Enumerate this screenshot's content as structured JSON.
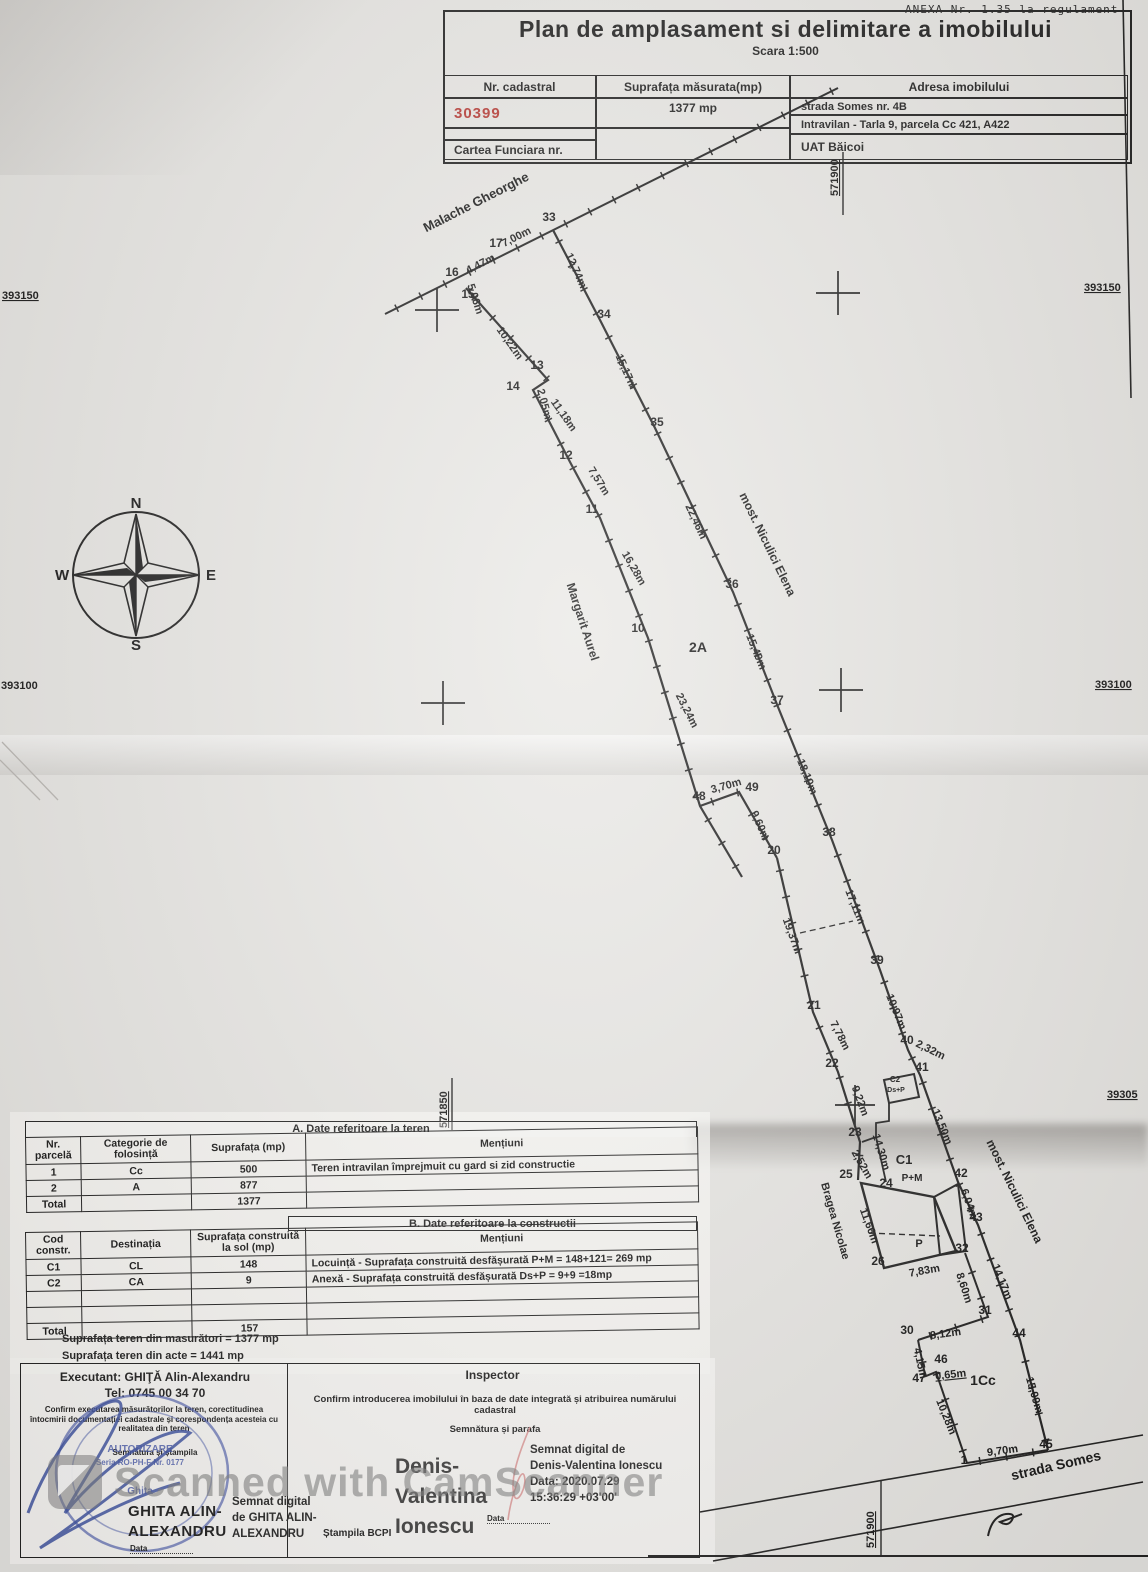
{
  "annex": "ANEXA Nr. 1.35 la regulament",
  "title": "Plan de amplasament si delimitare a imobilului",
  "scale_note": "Scara 1:500",
  "header_table": {
    "nr_cadastral_label": "Nr. cadastral",
    "nr_cadastral_value": "30399",
    "suprafata_label": "Suprafața măsurata(mp)",
    "suprafata_value": "1377 mp",
    "adresa_label": "Adresa imobilului",
    "adresa_line1": "strada Somes nr. 4B",
    "adresa_line2": "Intravilan - Tarla 9, parcela Cc 421, A422",
    "carte_funciara_label": "Cartea Funciara nr.",
    "uat_value": "UAT  Băicoi"
  },
  "compass": {
    "n": "N",
    "e": "E",
    "s": "S",
    "w": "W"
  },
  "table_a": {
    "title": "A. Date referitoare la teren",
    "headers": [
      "Nr. parcelă",
      "Categorie de folosință",
      "Suprafața (mp)",
      "Mențiuni"
    ],
    "rows": [
      [
        "1",
        "Cc",
        "500",
        "Teren intravilan împrejmuit cu gard si zid constructie"
      ],
      [
        "2",
        "A",
        "877",
        ""
      ],
      [
        "Total",
        "",
        "1377",
        ""
      ]
    ]
  },
  "table_b": {
    "title": "B. Date referitoare la constructii",
    "headers": [
      "Cod constr.",
      "Destinația",
      "Suprafața construită la sol (mp)",
      "Mențiuni"
    ],
    "rows": [
      [
        "C1",
        "CL",
        "148",
        "Locuință - Suprafața construită desfășurată P+M = 148+121= 269 mp"
      ],
      [
        "C2",
        "CA",
        "9",
        "Anexă - Suprafața construită desfășurată Ds+P = 9+9 =18mp"
      ],
      [
        "",
        "",
        "",
        ""
      ],
      [
        "",
        "",
        "",
        ""
      ],
      [
        "Total",
        "",
        "157",
        ""
      ]
    ]
  },
  "summary": {
    "line1": "Suprafața teren din masurători = 1377 mp",
    "line2": "Suprafața teren din acte = 1441 mp"
  },
  "signature": {
    "executant_label": "Executant: GHIŢĂ Alin-Alexandru",
    "executant_tel": "Tel: 0745 00 34 70",
    "executant_confirm": "Confirm executarea măsurătorilor la teren, corectitudinea întocmirii documentației cadastrale și corespondența acesteia cu realitatea din teren",
    "semnatura_stampila": "Semnătura și ștampila",
    "stamp_line1": "AUTORIZARE",
    "stamp_line2": "Seria RO-PH-F Nr. 0177",
    "stamp_line3": "Ghita",
    "executant_name_l1": "GHITA ALIN-",
    "executant_name_l2": "ALEXANDRU",
    "executant_digital": [
      "Semnat digital",
      "de GHITA ALIN-",
      "ALEXANDRU"
    ],
    "data_label": "Data",
    "inspector_label": "Inspector",
    "inspector_confirm": "Confirm introducerea imobilului în baza de date integrată și atribuirea numărului cadastral",
    "semnatura_parafa": "Semnătura și parafa",
    "inspector_name": [
      "Denis-",
      "Valentina",
      "Ionescu"
    ],
    "inspector_digital": [
      "Semnat digital de",
      "Denis-Valentina Ionescu",
      "Data: 2020.07.29",
      "15:36:29 +03'00'"
    ],
    "stampila_bcpi": "Ștampila BCPI"
  },
  "watermark": "Scanned with CamScanner",
  "colors": {
    "cadastral_red": "#b5342e",
    "stamp_blue": "#4053a8",
    "parafa_red": "#d98a8a"
  },
  "plan": {
    "points": [
      {
        "t": "15",
        "x": 468,
        "y": 298
      },
      {
        "t": "16",
        "x": 452,
        "y": 276
      },
      {
        "t": "17",
        "x": 496,
        "y": 247
      },
      {
        "t": "33",
        "x": 549,
        "y": 221
      },
      {
        "t": "13",
        "x": 537,
        "y": 369
      },
      {
        "t": "14",
        "x": 513,
        "y": 390
      },
      {
        "t": "12",
        "x": 566,
        "y": 459
      },
      {
        "t": "11",
        "x": 592,
        "y": 513
      },
      {
        "t": "34",
        "x": 604,
        "y": 318
      },
      {
        "t": "35",
        "x": 657,
        "y": 426
      },
      {
        "t": "10",
        "x": 638,
        "y": 632
      },
      {
        "t": "36",
        "x": 732,
        "y": 588
      },
      {
        "t": "37",
        "x": 777,
        "y": 704
      },
      {
        "t": "48",
        "x": 699,
        "y": 800
      },
      {
        "t": "49",
        "x": 752,
        "y": 791
      },
      {
        "t": "20",
        "x": 774,
        "y": 854
      },
      {
        "t": "38",
        "x": 829,
        "y": 836
      },
      {
        "t": "39",
        "x": 877,
        "y": 964
      },
      {
        "t": "21",
        "x": 814,
        "y": 1009
      },
      {
        "t": "22",
        "x": 832,
        "y": 1067
      },
      {
        "t": "40",
        "x": 907,
        "y": 1044
      },
      {
        "t": "41",
        "x": 922,
        "y": 1071
      },
      {
        "t": "23",
        "x": 855,
        "y": 1136
      },
      {
        "t": "25",
        "x": 846,
        "y": 1178
      },
      {
        "t": "24",
        "x": 886,
        "y": 1187
      },
      {
        "t": "42",
        "x": 961,
        "y": 1177
      },
      {
        "t": "43",
        "x": 976,
        "y": 1221
      },
      {
        "t": "26",
        "x": 878,
        "y": 1265
      },
      {
        "t": "32",
        "x": 962,
        "y": 1252
      },
      {
        "t": "31",
        "x": 985,
        "y": 1314
      },
      {
        "t": "30",
        "x": 907,
        "y": 1334
      },
      {
        "t": "47",
        "x": 919,
        "y": 1382
      },
      {
        "t": "46",
        "x": 941,
        "y": 1363
      },
      {
        "t": "44",
        "x": 1019,
        "y": 1337
      },
      {
        "t": "45",
        "x": 1046,
        "y": 1448
      },
      {
        "t": "1",
        "x": 964,
        "y": 1464
      }
    ],
    "distances": [
      {
        "t": "7,00m",
        "x": 518,
        "y": 240,
        "r": -27
      },
      {
        "t": "4,47m",
        "x": 482,
        "y": 267,
        "r": -27
      },
      {
        "t": "5,06m",
        "x": 472,
        "y": 300,
        "r": 72
      },
      {
        "t": "10,22m",
        "x": 507,
        "y": 345,
        "r": 55
      },
      {
        "t": "2,05m",
        "x": 541,
        "y": 405,
        "r": 75
      },
      {
        "t": "11,18m",
        "x": 561,
        "y": 417,
        "r": 55
      },
      {
        "t": "7,57m",
        "x": 596,
        "y": 483,
        "r": 58
      },
      {
        "t": "16,28m",
        "x": 631,
        "y": 570,
        "r": 60
      },
      {
        "t": "23,24m",
        "x": 684,
        "y": 712,
        "r": 63
      },
      {
        "t": "3,70m",
        "x": 727,
        "y": 789,
        "r": -16
      },
      {
        "t": "9,60m",
        "x": 757,
        "y": 827,
        "r": 66
      },
      {
        "t": "19,37m",
        "x": 789,
        "y": 937,
        "r": 70
      },
      {
        "t": "7,78m",
        "x": 837,
        "y": 1037,
        "r": 63
      },
      {
        "t": "9,22m",
        "x": 857,
        "y": 1102,
        "r": 70
      },
      {
        "t": "14,30m",
        "x": 878,
        "y": 1153,
        "r": 73
      },
      {
        "t": "2,52m",
        "x": 859,
        "y": 1166,
        "r": 60
      },
      {
        "t": "11,66m",
        "x": 866,
        "y": 1227,
        "r": 70
      },
      {
        "t": "7,83m",
        "x": 925,
        "y": 1274,
        "r": -10
      },
      {
        "t": "8,60m",
        "x": 961,
        "y": 1289,
        "r": 72
      },
      {
        "t": "8,12m",
        "x": 946,
        "y": 1337,
        "r": -8
      },
      {
        "t": "4,15m",
        "x": 917,
        "y": 1364,
        "r": 78
      },
      {
        "t": "0,65m",
        "x": 951,
        "y": 1378,
        "r": -6,
        "u": true
      },
      {
        "t": "10,28m",
        "x": 943,
        "y": 1418,
        "r": 68
      },
      {
        "t": "9,70m",
        "x": 1003,
        "y": 1454,
        "r": -8
      },
      {
        "t": "12,74m",
        "x": 573,
        "y": 272,
        "r": 66
      },
      {
        "t": "15,17m",
        "x": 623,
        "y": 373,
        "r": 66
      },
      {
        "t": "22,46m",
        "x": 693,
        "y": 523,
        "r": 65
      },
      {
        "t": "15,40m",
        "x": 753,
        "y": 653,
        "r": 68
      },
      {
        "t": "18,10m",
        "x": 804,
        "y": 778,
        "r": 68
      },
      {
        "t": "17,11m",
        "x": 852,
        "y": 908,
        "r": 68
      },
      {
        "t": "10,97m",
        "x": 893,
        "y": 1013,
        "r": 68
      },
      {
        "t": "2,32m",
        "x": 929,
        "y": 1053,
        "r": 26
      },
      {
        "t": "13,50m",
        "x": 939,
        "y": 1128,
        "r": 68
      },
      {
        "t": "6,04m",
        "x": 966,
        "y": 1205,
        "r": 70
      },
      {
        "t": "14,17m",
        "x": 999,
        "y": 1283,
        "r": 68
      },
      {
        "t": "15,09m",
        "x": 1031,
        "y": 1396,
        "r": 74
      }
    ],
    "names": [
      {
        "t": "Malache Gheorghe",
        "x": 478,
        "y": 206,
        "r": -27,
        "s": 13
      },
      {
        "t": "most. Niculici Elena",
        "x": 764,
        "y": 546,
        "r": 64,
        "s": 12
      },
      {
        "t": "Margarit Aurel",
        "x": 579,
        "y": 623,
        "r": 72,
        "s": 12
      },
      {
        "t": "most. Niculici Elena",
        "x": 1011,
        "y": 1193,
        "r": 64,
        "s": 12
      },
      {
        "t": "Bragea Nicolae",
        "x": 832,
        "y": 1222,
        "r": 74,
        "s": 11
      },
      {
        "t": "strada Somes",
        "x": 1057,
        "y": 1470,
        "r": -13,
        "s": 14
      }
    ],
    "parcel_labels": [
      {
        "t": "2A",
        "x": 698,
        "y": 652,
        "s": 14
      },
      {
        "t": "1Cc",
        "x": 983,
        "y": 1385,
        "s": 14
      },
      {
        "t": "C1",
        "x": 904,
        "y": 1164,
        "s": 13
      },
      {
        "t": "P+M",
        "x": 912,
        "y": 1181,
        "s": 10
      },
      {
        "t": "P",
        "x": 919,
        "y": 1247,
        "s": 11
      },
      {
        "t": "C2",
        "x": 895,
        "y": 1082,
        "s": 8
      },
      {
        "t": "Ds+P",
        "x": 896,
        "y": 1092,
        "s": 7
      }
    ],
    "coord_labels": [
      {
        "t": "393150",
        "x": 2,
        "y": 299,
        "r": 0,
        "u": true
      },
      {
        "t": "393150",
        "x": 1084,
        "y": 291,
        "r": 0,
        "u": true
      },
      {
        "t": "393100",
        "x": 1,
        "y": 689,
        "r": 0,
        "u": false
      },
      {
        "t": "393100",
        "x": 1095,
        "y": 688,
        "r": 0,
        "u": true
      },
      {
        "t": "39305",
        "x": 1107,
        "y": 1098,
        "r": 0,
        "u": true
      },
      {
        "t": "571900",
        "x": 838,
        "y": 196,
        "r": -90,
        "u": true
      },
      {
        "t": "571850",
        "x": 447,
        "y": 1128,
        "r": -90,
        "u": true
      },
      {
        "t": "571900",
        "x": 874,
        "y": 1548,
        "r": -90,
        "u": true
      }
    ]
  }
}
